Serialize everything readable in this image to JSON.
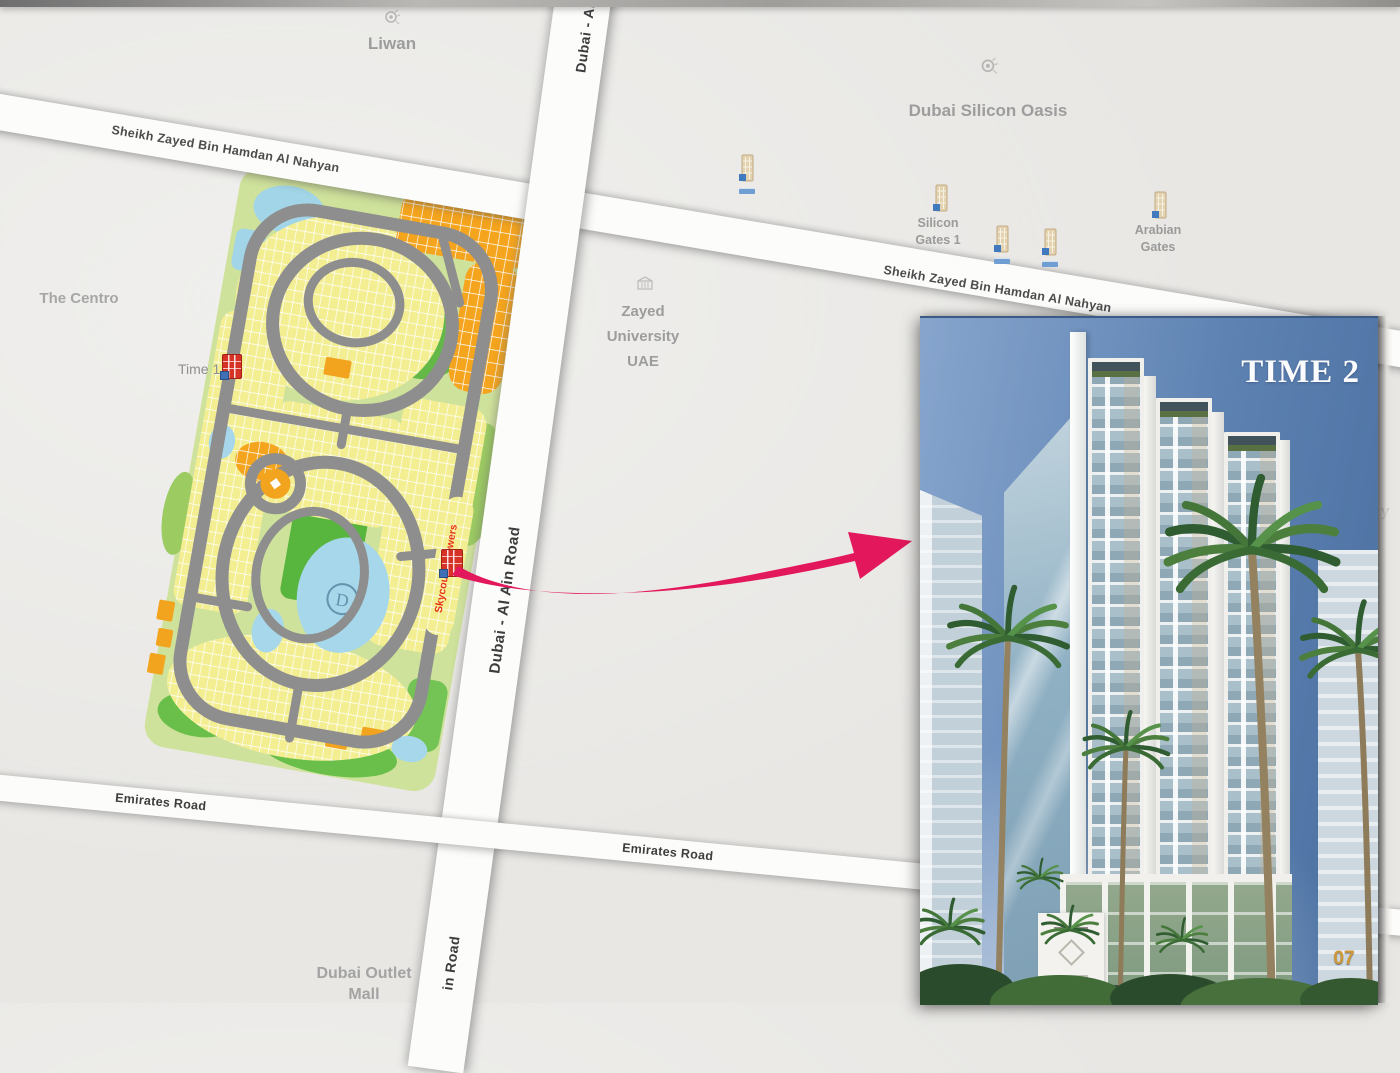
{
  "colors": {
    "arrow": "#e2175c",
    "road": "#fcfcfb",
    "map_background": "#e8e7e4",
    "label_gray": "#9d9d9d",
    "gold": "#cf9838"
  },
  "map": {
    "poi": {
      "liwan": "Liwan",
      "dso": "Dubai Silicon Oasis",
      "centro": "The Centro",
      "zayed1": "Zayed",
      "zayed2": "University",
      "zayed3": "UAE",
      "time1": "Time 1",
      "sg1": "Silicon",
      "sg2": "Gates 1",
      "ag1": "Arabian",
      "ag2": "Gates",
      "outlet1": "Dubai Outlet",
      "outlet2": "Mall",
      "partial": "y"
    },
    "roads": {
      "szbhan1": "Sheikh Zayed Bin Hamdan Al Nahyan",
      "szbhan2": "Sheikh Zayed Bin Hamdan Al Nahyan",
      "daar_top": "Dubai - Al",
      "daar_mid": "Dubai - Al Ain Road",
      "daar_bottom": "in Road",
      "emirates1": "Emirates Road",
      "emirates2": "Emirates Road"
    },
    "plan": {
      "skycourts": "Skycourts Towers",
      "monogram": "D"
    }
  },
  "inset": {
    "title": "TIME 2",
    "page": "07"
  }
}
